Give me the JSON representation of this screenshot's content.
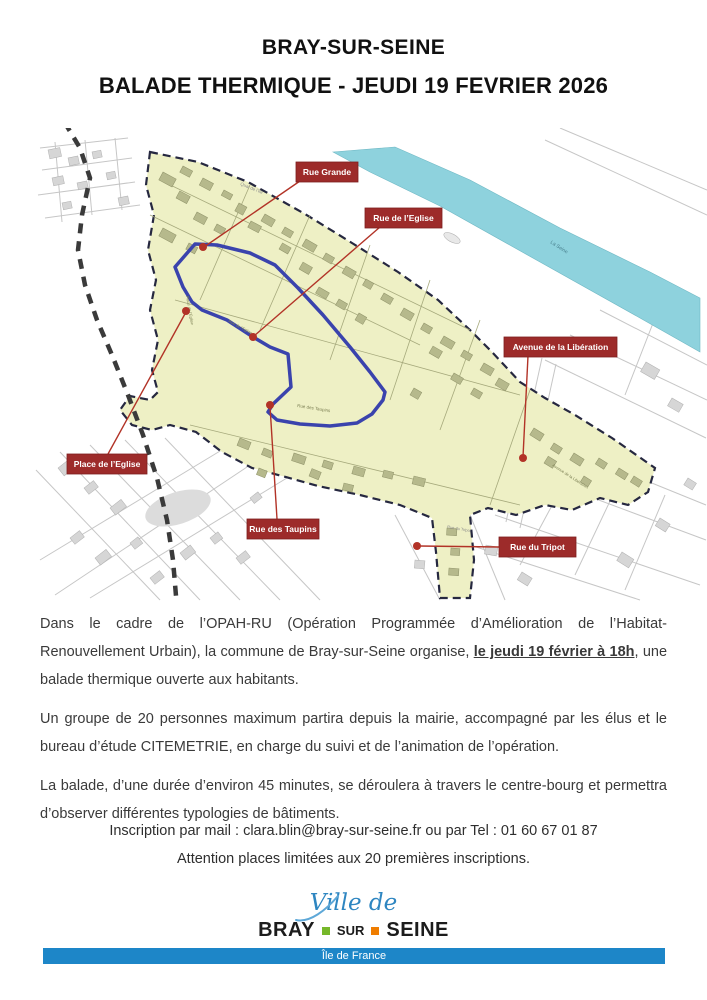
{
  "title": {
    "line1": "BRAY-SUR-SEINE",
    "line2": "BALADE THERMIQUE - JEUDI 19 FEVRIER 2026"
  },
  "map": {
    "colors": {
      "zone_fill": "#eef0c5",
      "zone_border": "#262840",
      "river": "#8ed2dd",
      "route": "#3a43ad",
      "connector": "#b23327",
      "callout_bg": "#9d2b2a",
      "callout_text": "#ffffff",
      "building_in": "#b6b98c",
      "building_out": "#d6d6d6"
    },
    "callouts": [
      {
        "label": "Rue Grande",
        "box": {
          "x": 296,
          "y": 162,
          "w": 62,
          "h": 20
        },
        "dot": {
          "x": 203,
          "y": 247
        },
        "line": {
          "x1": 300,
          "y1": 181,
          "x2": 204,
          "y2": 247
        }
      },
      {
        "label": "Rue de l’Eglise",
        "box": {
          "x": 365,
          "y": 208,
          "w": 77,
          "h": 20
        },
        "dot": {
          "x": 253,
          "y": 337
        },
        "line": {
          "x1": 380,
          "y1": 227,
          "x2": 254,
          "y2": 336
        }
      },
      {
        "label": "Avenue de la Libération",
        "box": {
          "x": 504,
          "y": 337,
          "w": 113,
          "h": 20
        },
        "dot": {
          "x": 523,
          "y": 458
        },
        "line": {
          "x1": 528,
          "y1": 356,
          "x2": 523,
          "y2": 457
        }
      },
      {
        "label": "Place de l’Eglise",
        "box": {
          "x": 67,
          "y": 454,
          "w": 80,
          "h": 20
        },
        "dot": {
          "x": 186,
          "y": 311
        },
        "line": {
          "x1": 108,
          "y1": 454,
          "x2": 186,
          "y2": 312
        }
      },
      {
        "label": "Rue des Taupins",
        "box": {
          "x": 247,
          "y": 519,
          "w": 72,
          "h": 20
        },
        "dot": {
          "x": 270,
          "y": 405
        },
        "line": {
          "x1": 277,
          "y1": 519,
          "x2": 270,
          "y2": 406
        }
      },
      {
        "label": "Rue du Tripot",
        "box": {
          "x": 499,
          "y": 537,
          "w": 77,
          "h": 20
        },
        "dot": {
          "x": 417,
          "y": 546
        },
        "line": {
          "x1": 499,
          "y1": 547,
          "x2": 419,
          "y2": 546
        }
      }
    ],
    "minor_labels": [
      {
        "text": "Quai de l’Ile",
        "x": 240,
        "y": 185,
        "angle": 22,
        "color": "#8a8a8a",
        "size": 4.5
      },
      {
        "text": "La Seine",
        "x": 550,
        "y": 243,
        "angle": 33,
        "color": "#49808e",
        "size": 5
      },
      {
        "text": "Place de l’Eglise",
        "x": 186,
        "y": 296,
        "angle": 80,
        "color": "#7d8055",
        "size": 4
      },
      {
        "text": "Rue de l’Eglise",
        "x": 228,
        "y": 322,
        "angle": 28,
        "color": "#7d8055",
        "size": 4
      },
      {
        "text": "Rue des Taupins",
        "x": 297,
        "y": 407,
        "angle": 9,
        "color": "#7d8055",
        "size": 4.5
      },
      {
        "text": "Avenue de la Libération",
        "x": 552,
        "y": 466,
        "angle": 33,
        "color": "#7d8055",
        "size": 4
      },
      {
        "text": "Rue du Tripot",
        "x": 447,
        "y": 528,
        "angle": 10,
        "color": "#8a8a8a",
        "size": 4
      }
    ]
  },
  "body": {
    "p1_before": "Dans le cadre de l’OPAH-RU (Opération Programmée d’Amélioration de l’Habitat-Renouvellement Urbain), la commune de Bray-sur-Seine organise, ",
    "p1_emphasis": "le jeudi 19 février à 18h",
    "p1_after": ", une balade thermique ouverte aux habitants.",
    "p2": "Un groupe de 20 personnes maximum partira depuis la mairie, accompagné par les élus et le bureau d’étude CITEMETRIE, en charge du suivi et de l’animation de l’opération.",
    "p3": "La balade, d’une durée d’environ 45 minutes, se déroulera à travers le centre-bourg et permettra d’observer différentes typologies de bâtiments.",
    "contact1": "Inscription par mail : clara.blin@bray-sur-seine.fr ou par Tel : 01 60 67 01 87",
    "contact2": "Attention places limitées aux 20 premières inscriptions."
  },
  "footer": {
    "script_text": "Ville de",
    "city_left": "BRAY",
    "city_mid": "SUR",
    "city_right": "SEINE",
    "region_bar": "Île de France",
    "colors": {
      "script": "#2e86c1",
      "bar": "#1d86c8",
      "square_green": "#76b82a",
      "square_orange": "#ef7d00"
    }
  }
}
